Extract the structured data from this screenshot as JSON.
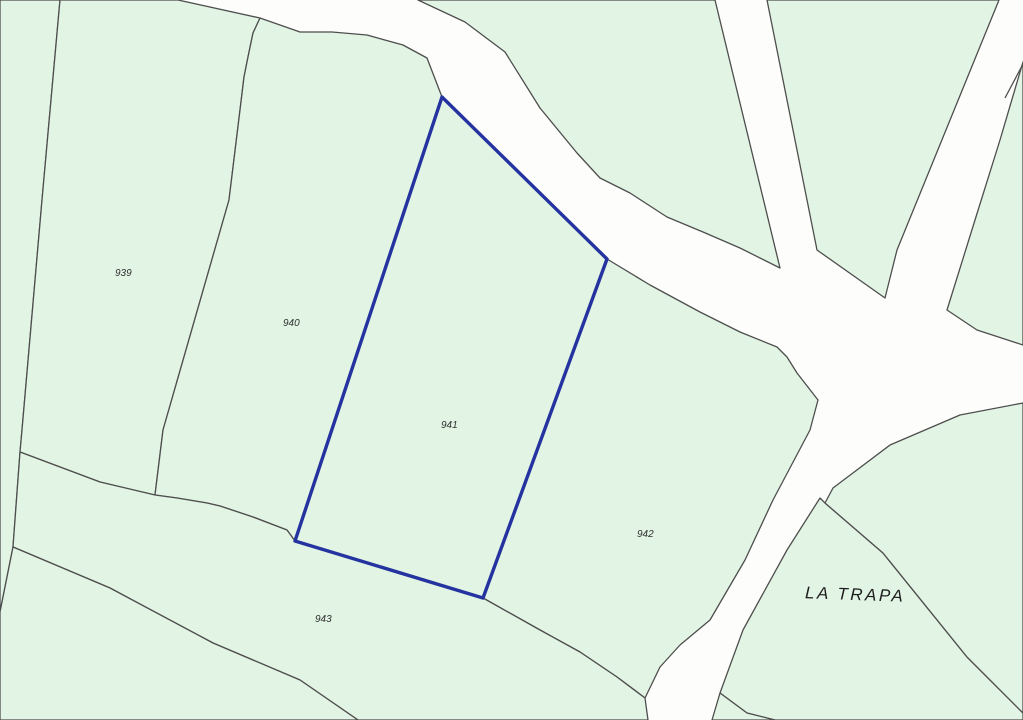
{
  "map": {
    "title": "cadastral-parcel-map",
    "place_label": {
      "text": "LA TRAPA",
      "x": 855,
      "y": 600,
      "rotation": 2,
      "font_size": 17,
      "letter_spacing": 2.5,
      "color": "#1e1e1e"
    },
    "colors": {
      "road_background": "#fdfdfb",
      "parcel_fill": "#e2f4e4",
      "parcel_stroke": "#4e4e4e",
      "highlight_stroke": "#2433a0",
      "label_color": "#2f2f2f"
    },
    "stroke_widths": {
      "parcel": 1.3,
      "highlight": 3.4
    },
    "label_font_size": 10,
    "parcels": [
      {
        "id": "edge-sliver-left",
        "label": "",
        "highlight": false,
        "points": [
          [
            0,
            0
          ],
          [
            60,
            0
          ],
          [
            42,
            200
          ],
          [
            22,
            430
          ],
          [
            20,
            452
          ],
          [
            13,
            547
          ],
          [
            0,
            612
          ]
        ]
      },
      {
        "id": "939",
        "label": "939",
        "label_x": 115,
        "label_y": 276,
        "highlight": false,
        "points": [
          [
            60,
            0
          ],
          [
            178,
            0
          ],
          [
            260,
            18
          ],
          [
            253,
            33
          ],
          [
            248,
            57
          ],
          [
            244,
            77
          ],
          [
            240,
            110
          ],
          [
            229,
            200
          ],
          [
            163,
            430
          ],
          [
            155,
            495
          ],
          [
            100,
            482
          ],
          [
            20,
            452
          ],
          [
            22,
            430
          ],
          [
            42,
            200
          ]
        ]
      },
      {
        "id": "940",
        "label": "940",
        "label_x": 283,
        "label_y": 326,
        "highlight": false,
        "points": [
          [
            260,
            18
          ],
          [
            300,
            32
          ],
          [
            332,
            32
          ],
          [
            367,
            35
          ],
          [
            403,
            45
          ],
          [
            427,
            58
          ],
          [
            442,
            97
          ],
          [
            295,
            541
          ],
          [
            287,
            530
          ],
          [
            253,
            517
          ],
          [
            220,
            506
          ],
          [
            207,
            503
          ],
          [
            177,
            498
          ],
          [
            155,
            495
          ],
          [
            163,
            430
          ],
          [
            229,
            200
          ],
          [
            240,
            110
          ],
          [
            244,
            77
          ],
          [
            248,
            57
          ],
          [
            253,
            33
          ]
        ]
      },
      {
        "id": "941",
        "label": "941",
        "label_x": 441,
        "label_y": 428,
        "highlight": true,
        "points": [
          [
            442,
            97
          ],
          [
            607,
            259
          ],
          [
            483,
            598
          ],
          [
            295,
            541
          ]
        ]
      },
      {
        "id": "942",
        "label": "942",
        "label_x": 637,
        "label_y": 537,
        "highlight": false,
        "points": [
          [
            607,
            259
          ],
          [
            650,
            285
          ],
          [
            700,
            312
          ],
          [
            740,
            332
          ],
          [
            777,
            347
          ],
          [
            787,
            357
          ],
          [
            797,
            373
          ],
          [
            818,
            400
          ],
          [
            810,
            430
          ],
          [
            782,
            483
          ],
          [
            773,
            500
          ],
          [
            745,
            560
          ],
          [
            710,
            620
          ],
          [
            680,
            645
          ],
          [
            660,
            667
          ],
          [
            645,
            698
          ],
          [
            617,
            677
          ],
          [
            580,
            652
          ],
          [
            540,
            630
          ],
          [
            483,
            598
          ]
        ]
      },
      {
        "id": "943",
        "label": "943",
        "label_x": 315,
        "label_y": 622,
        "highlight": false,
        "points": [
          [
            20,
            452
          ],
          [
            100,
            482
          ],
          [
            155,
            495
          ],
          [
            177,
            498
          ],
          [
            207,
            503
          ],
          [
            220,
            506
          ],
          [
            253,
            517
          ],
          [
            287,
            530
          ],
          [
            295,
            541
          ],
          [
            483,
            598
          ],
          [
            540,
            630
          ],
          [
            580,
            652
          ],
          [
            617,
            677
          ],
          [
            645,
            698
          ],
          [
            648,
            720
          ],
          [
            358,
            720
          ],
          [
            300,
            680
          ],
          [
            213,
            643
          ],
          [
            110,
            588
          ],
          [
            13,
            547
          ]
        ]
      },
      {
        "id": "bottom-left",
        "label": "",
        "highlight": false,
        "points": [
          [
            0,
            612
          ],
          [
            13,
            547
          ],
          [
            110,
            588
          ],
          [
            213,
            643
          ],
          [
            300,
            680
          ],
          [
            358,
            720
          ],
          [
            0,
            720
          ]
        ]
      },
      {
        "id": "wedge-north",
        "label": "",
        "highlight": false,
        "points": [
          [
            715,
            0
          ],
          [
            780,
            268
          ],
          [
            740,
            248
          ],
          [
            703,
            232
          ],
          [
            667,
            217
          ],
          [
            630,
            193
          ],
          [
            600,
            178
          ],
          [
            577,
            153
          ],
          [
            540,
            108
          ],
          [
            505,
            52
          ],
          [
            465,
            22
          ],
          [
            418,
            0
          ]
        ]
      },
      {
        "id": "wedge-northeast",
        "label": "",
        "highlight": false,
        "points": [
          [
            767,
            0
          ],
          [
            817,
            250
          ],
          [
            885,
            298
          ],
          [
            897,
            250
          ],
          [
            999,
            0
          ]
        ]
      },
      {
        "id": "east-corner",
        "label": "",
        "highlight": false,
        "points": [
          [
            1023,
            62
          ],
          [
            1000,
            140
          ],
          [
            975,
            220
          ],
          [
            947,
            310
          ],
          [
            977,
            330
          ],
          [
            1023,
            345
          ]
        ]
      },
      {
        "id": "la-trapa",
        "label": "",
        "highlight": false,
        "points": [
          [
            820,
            498
          ],
          [
            825,
            503
          ],
          [
            883,
            553
          ],
          [
            967,
            657
          ],
          [
            1023,
            713
          ],
          [
            1023,
            720
          ],
          [
            775,
            720
          ],
          [
            747,
            713
          ],
          [
            720,
            693
          ],
          [
            743,
            630
          ],
          [
            787,
            550
          ]
        ]
      },
      {
        "id": "southeast",
        "label": "",
        "highlight": false,
        "points": [
          [
            825,
            503
          ],
          [
            833,
            488
          ],
          [
            890,
            445
          ],
          [
            960,
            415
          ],
          [
            1023,
            403
          ],
          [
            1023,
            713
          ],
          [
            967,
            657
          ],
          [
            883,
            553
          ]
        ]
      },
      {
        "id": "bottom-triangle",
        "label": "",
        "highlight": false,
        "points": [
          [
            720,
            693
          ],
          [
            712,
            720
          ],
          [
            775,
            720
          ],
          [
            747,
            713
          ]
        ]
      }
    ],
    "extra_lines": [
      [
        [
          1005,
          98
        ],
        [
          1023,
          64
        ]
      ]
    ]
  }
}
